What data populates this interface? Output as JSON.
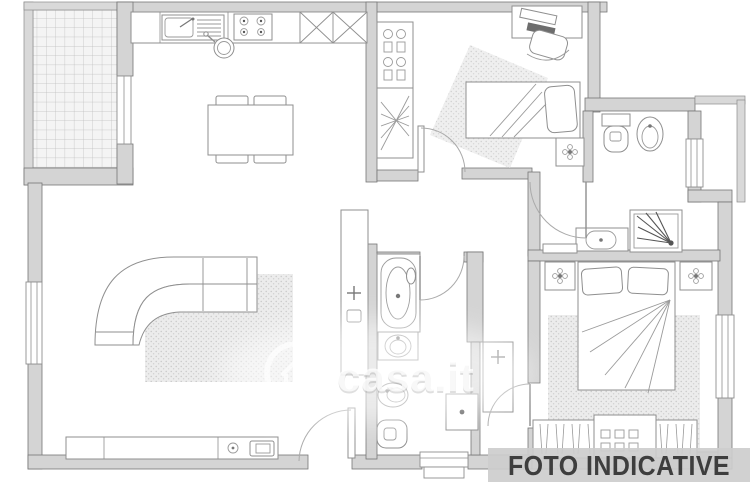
{
  "image_type": "real-estate-floor-plan",
  "banner": {
    "label": "FOTO INDICATIVE",
    "bg": "#cdcdcd",
    "fg": "#3e3e3e"
  },
  "watermark": {
    "text": "casa.it",
    "logo": "casa-house-logo-icon",
    "color": "#ffffff"
  },
  "colors": {
    "background": "#ffffff",
    "wall_fill": "#d4d4d4",
    "wall_stroke": "#767676",
    "furniture_stroke": "#8f8f8f",
    "rug_dot": "#c6c6c6",
    "tile_line": "#bdbdbd"
  },
  "rooms": [
    {
      "name": "balcony",
      "features": [
        "tiled-floor"
      ]
    },
    {
      "name": "living-room-kitchen",
      "features": [
        "kitchen-sink",
        "stove",
        "kitchen-cabinets",
        "cooking-pot",
        "dining-table",
        "four-chairs",
        "corner-sofa",
        "rug",
        "sideboard",
        "tv",
        "entrance-door",
        "balcony-door",
        "window"
      ]
    },
    {
      "name": "bedroom-1",
      "features": [
        "shelf-unit",
        "desk",
        "desk-chair",
        "single-bed",
        "rug",
        "nightstand",
        "door"
      ]
    },
    {
      "name": "bathroom-1",
      "features": [
        "toilet",
        "bidet",
        "shower",
        "washbasin",
        "window",
        "door"
      ]
    },
    {
      "name": "hallway",
      "features": [
        "bench"
      ]
    },
    {
      "name": "bathroom-2",
      "features": [
        "bathtub",
        "washbasin",
        "bidet",
        "toilet",
        "washing-machine",
        "window",
        "door"
      ]
    },
    {
      "name": "corridor",
      "features": [
        "cabinet"
      ]
    },
    {
      "name": "bedroom-2",
      "features": [
        "double-bed",
        "nightstand",
        "nightstand",
        "rug",
        "wardrobe",
        "window"
      ]
    }
  ]
}
